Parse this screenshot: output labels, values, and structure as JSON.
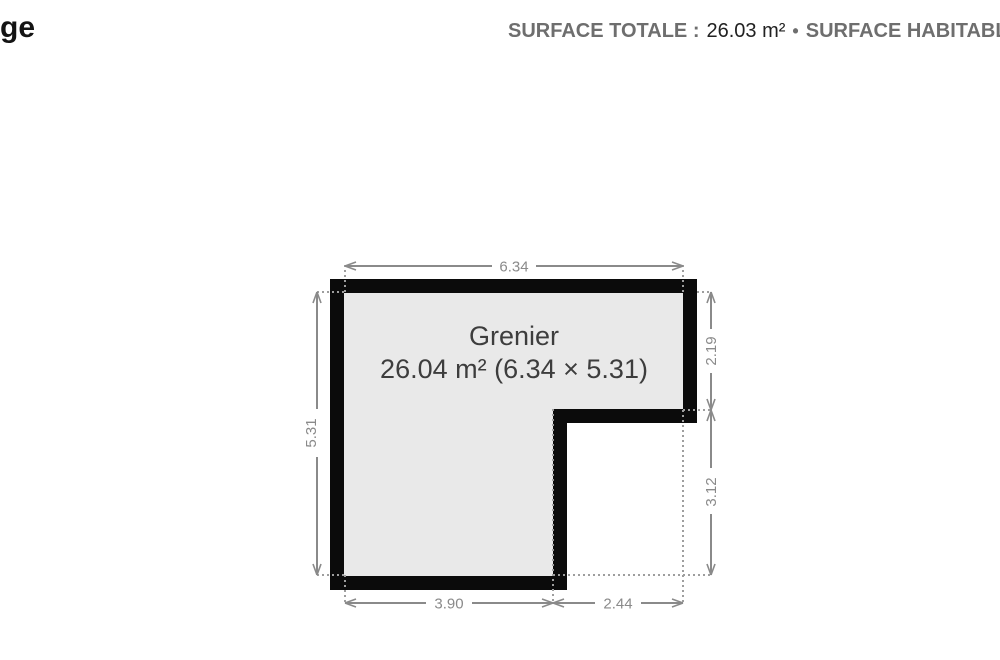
{
  "header": {
    "title_partial": "ge",
    "surface_totale_label": "SURFACE TOTALE :",
    "surface_totale_value": "26.03 m²",
    "separator": "•",
    "surface_habitable_label": "SURFACE HABITABLE :",
    "surface_habitable_value": "26.0"
  },
  "floorplan": {
    "room": {
      "name": "Grenier",
      "area_line": "26.04 m² (6.34 × 5.31)"
    },
    "dimensions": {
      "top": "6.34",
      "left": "5.31",
      "right_upper": "2.19",
      "right_lower": "3.12",
      "bottom_left": "3.90",
      "bottom_right": "2.44"
    },
    "colors": {
      "wall": "#0b0b0b",
      "room_fill": "#e9e9e9",
      "dimension_gray": "#8a8a8a",
      "room_label": "#3d3d3d",
      "header_label_gray": "#6e6e6e",
      "header_value_dark": "#212121"
    }
  }
}
